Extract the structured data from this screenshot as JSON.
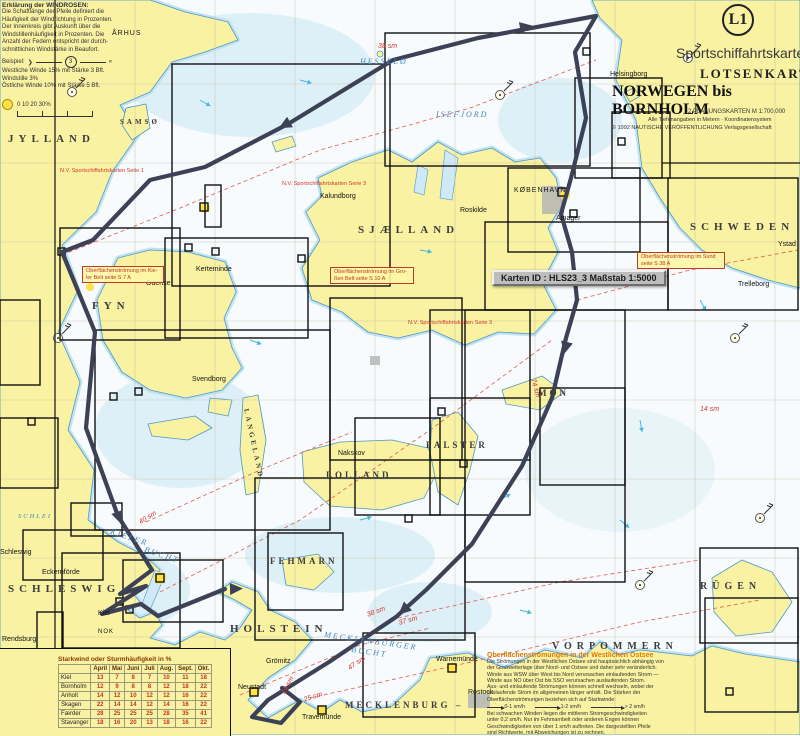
{
  "header": {
    "badge": "L1",
    "series": "Sportschiffahrtskarten",
    "product": "LOTSENKARTEN",
    "title": "NORWEGEN bis BORNHOLM",
    "line1": "2 PLANUNGSKARTEN   M 1:700.000",
    "line2": "Alle Tiefenangaben in Metern · Koordinatensystem",
    "line3": "© 1992 NAUTISCHE VERÖFFENTLICHUNG Verlagsgesellschaft"
  },
  "wind_legend": {
    "title": "Erklärung der WINDROSEN:",
    "body": "Die Schaftlänge der Pfeile definiert die\nHäufigkeit der Windrichtung in Prozenten.\nDer Innenkreis gibt Auskunft über die\nWindstillenhäufigkeit in Prozenten. Die\nAnzahl der Federn entspricht der durch-\nschnittlichen Windstärke in Beaufort.",
    "example_label": "Beispiel:",
    "example_value": "3",
    "lines": "Westliche Winde 15% mit Stärke 3 Bft.\nWindstille 3%\nÖstliche Winde 10% mit Stärke 5 Bft.",
    "scale": "0         10         20        30%"
  },
  "wind_table": {
    "title": "Starkwind oder Sturmhäufigkeit in %",
    "columns": [
      "April",
      "Mai",
      "Juni",
      "Juli",
      "Aug.",
      "Sept.",
      "Okt."
    ],
    "rows": [
      {
        "station": "Kiel",
        "values": [
          13,
          7,
          8,
          7,
          10,
          11,
          18
        ]
      },
      {
        "station": "Bornholm",
        "values": [
          12,
          9,
          8,
          8,
          12,
          18,
          22
        ]
      },
      {
        "station": "Anholt",
        "values": [
          14,
          12,
          10,
          12,
          12,
          16,
          22
        ]
      },
      {
        "station": "Skagen",
        "values": [
          22,
          14,
          14,
          12,
          14,
          16,
          22
        ]
      },
      {
        "station": "Færder",
        "values": [
          28,
          25,
          25,
          25,
          28,
          35,
          41
        ]
      },
      {
        "station": "Stavanger",
        "values": [
          18,
          16,
          20,
          13,
          18,
          16,
          22
        ]
      }
    ]
  },
  "currents_note": {
    "title": "Oberflächenströmungen in der Westlichen Ostsee",
    "body1": "Die Strömungen in der Westlichen Ostsee sind hauptsächlich abhängig von\nder Großwetterlage über Nord- und Ostsee und daher sehr veränderlich.\nWinde aus WSW über West bis Nord verursachen einlaufenden Strom —\nWinde aus NO über Ost bis SSO verursachen auslaufenden Strom.\nAus- und einlaufende Strömungen können schnell wechseln, wobei der\nauslaufende Strom im allgemeinen länger anhält. Die Stärken der\nOberflächenströmungen beziehen sich auf Starkwinde:",
    "legend": [
      {
        "label": "0-1 sm/h"
      },
      {
        "label": "1-2 sm/h"
      },
      {
        "label": "> 2 sm/h"
      }
    ],
    "body2": "Bei schwachen Winden liegen die mittleren Stromgeschwindigkeiten\nunter 0,2 sm/h. Nur im Fehmarnbelt oder anderen Engen können\nGeschwindigkeiten von über 1 sm/h auftreten. Die dargestellten Pfeile\nsind Richtwerte, mit Abweichungen ist zu rechnen."
  },
  "map": {
    "karten_tip": "Karten ID : HLS23_3    Maßstab 1:5000",
    "regions": [
      "JYLLAND",
      "FYN",
      "SJÆLLAND",
      "SCHWEDEN",
      "LOLLAND",
      "FALSTER",
      "MØN",
      "FEHMARN",
      "SCHLESWIG –",
      "HOLSTEIN",
      "MECKLENBURG –",
      "VORPOMMERN",
      "RÜGEN",
      "LANGELAND",
      "SAMSØ"
    ],
    "waters": [
      "HESSELØ",
      "ISEFJORD",
      "KIELER",
      "BUCHT",
      "MECKLENBURGER",
      "BUCHT",
      "SCHLEI"
    ],
    "towns": [
      "ÅRHUS",
      "Kalundborg",
      "Roskilde",
      "KØBENHAVN",
      "Amager",
      "Helsingborg",
      "Odense",
      "Kerteminde",
      "Nakskov",
      "Trelleborg",
      "Ystad",
      "Grömitz",
      "Neustadt",
      "Travemünde",
      "Warnemünde",
      "Rostock",
      "Schleswig",
      "Rendsburg",
      "Kiel",
      "NOK",
      "Eckernförde",
      "Svendborg"
    ],
    "notes": [
      "Oberflächenströmung im Kie-\nler Belt seite S 7 A",
      "Oberflächenströmung im Gro-\nßen Belt seite S 10 A",
      "Oberflächenströmung im Sund\nseite S 38 A"
    ],
    "nv_labels": [
      "N.V. Sportschiffahrtskarten Seite 1",
      "N.V. Sportschiffahrtskarten Serie 3",
      "N.V. Sportschiffahrtskarten Serie 3"
    ],
    "distances": [
      "38 sm",
      "38 sm",
      "37 sm",
      "47 sm",
      "14 sm",
      "25 sm",
      "74 sm",
      "40 sm",
      "14 sm"
    ]
  }
}
